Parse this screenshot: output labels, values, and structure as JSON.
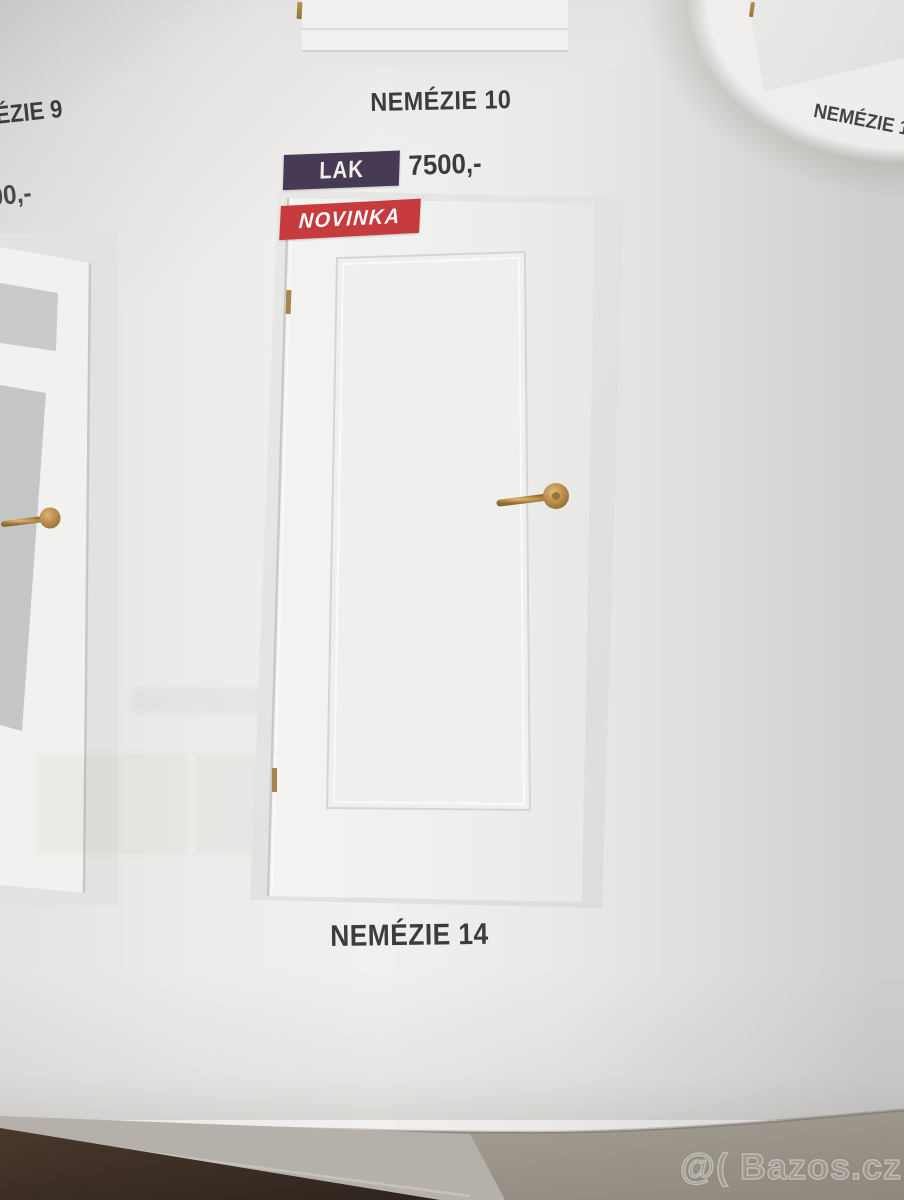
{
  "products": {
    "top_left": {
      "caption_partial": "ÉZIE 9",
      "price_partial": "00,-"
    },
    "top_center": {
      "caption": "NEMÉZIE 10"
    },
    "top_right": {
      "caption_partial": "NEMÉZIE 1"
    },
    "main": {
      "caption": "NEMÉZIE 14",
      "finish_badge": "LAK",
      "price": "7500,-",
      "new_flag": "NOVINKA"
    }
  },
  "watermark": {
    "text": "@( Bazos.cz"
  },
  "colors": {
    "lak_badge_purple": "#473a54",
    "novinka_red": "#c63c3e",
    "price_text": "#3d3c3b",
    "caption_text": "#3c3c3b",
    "brass_gold": "#b08647",
    "photo_background": "#e4e4e2",
    "page_white": "#efeeec",
    "floor_brown": "#3c2e25",
    "surface_taupe": "#99938a"
  },
  "icons": {
    "door_handle": "gold-lever-handle",
    "door_hinge": "brass-hinge"
  }
}
